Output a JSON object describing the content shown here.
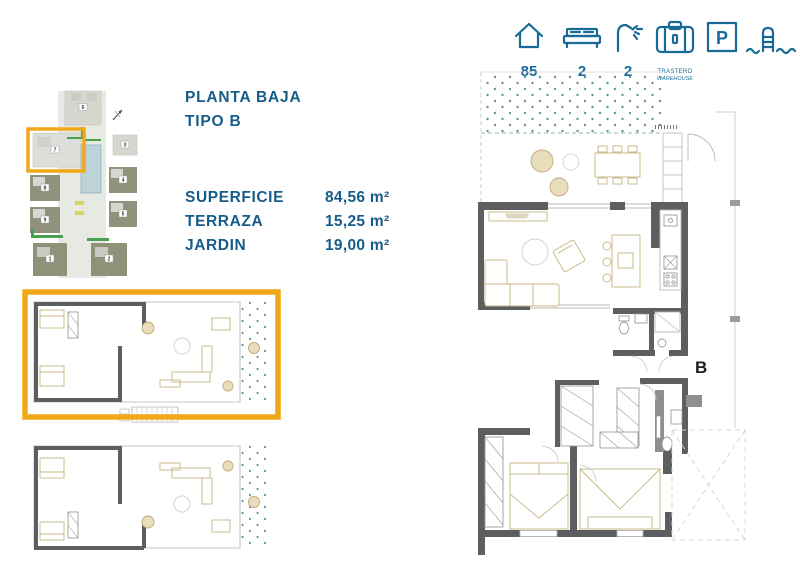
{
  "colors": {
    "accent_blue": "#1A6A97",
    "title_blue": "#165C88",
    "highlight_orange": "#F0A818",
    "wall_gray": "#5D5E60",
    "furniture_tan": "#C6B583",
    "garden_dot_green": "#5E9A8C"
  },
  "header": {
    "features": [
      {
        "icon": "house-icon",
        "value": "85"
      },
      {
        "icon": "bed-icon",
        "value": "2"
      },
      {
        "icon": "shower-icon",
        "value": "2"
      },
      {
        "icon": "storage-icon",
        "label_line1": "TRASTERO",
        "label_line2": "WAREHOUSE"
      },
      {
        "icon": "parking-icon",
        "letter": "P"
      },
      {
        "icon": "pool-icon"
      }
    ]
  },
  "info": {
    "title_line1": "PLANTA BAJA",
    "title_line2": "TIPO B",
    "areas": [
      {
        "label": "SUPERFICIE",
        "value": "84,56 m²"
      },
      {
        "label": "TERRAZA",
        "value": "15,25 m²"
      },
      {
        "label": "JARDIN",
        "value": "19,00 m²"
      }
    ]
  },
  "site_plan": {
    "highlighted_building": "7",
    "building_numbers": [
      "6",
      "7",
      "3",
      "4",
      "5",
      "8",
      "9",
      "1",
      "2"
    ]
  },
  "main_plan": {
    "unit_label": "B"
  }
}
